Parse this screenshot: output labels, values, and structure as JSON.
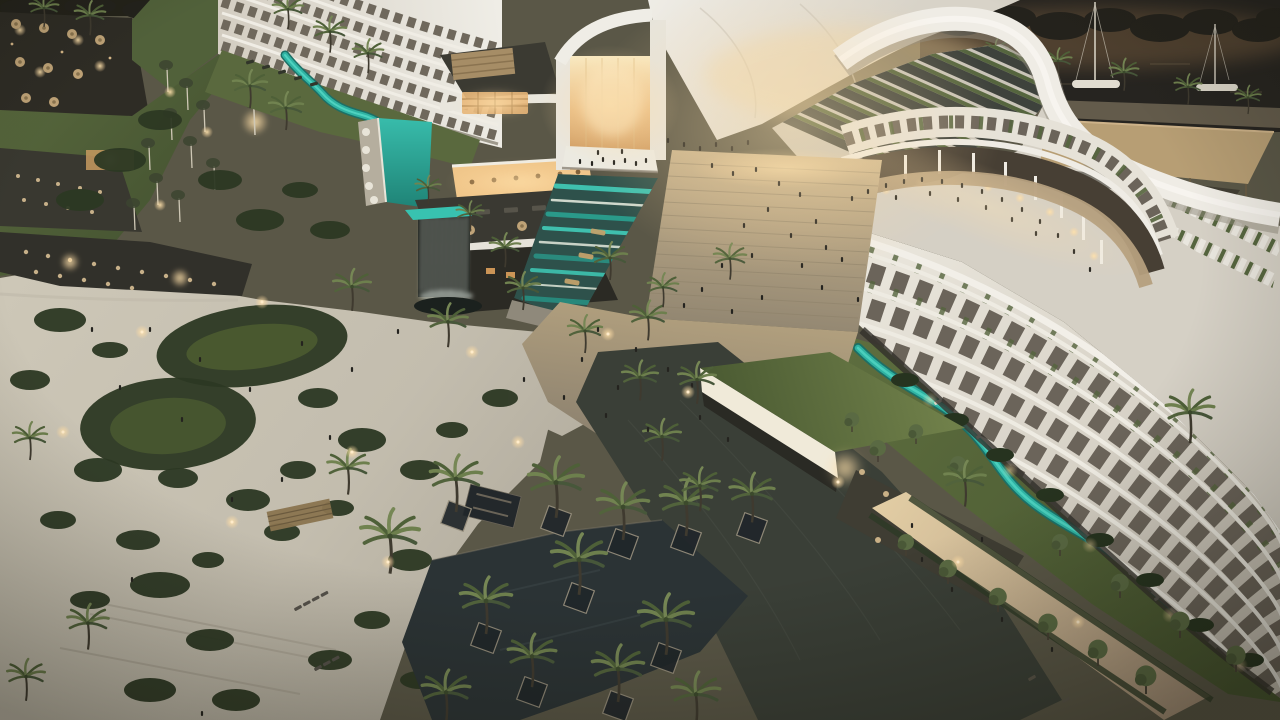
{
  "scene": {
    "title": "Aerial dusk rendering of a crescent-shaped luxury resort",
    "type": "architectural-visualization",
    "time_of_day": "dusk",
    "elements": [
      "curved white hotel wing with balcony grid",
      "glowing glass atrium under white canopy roof",
      "grand staircase with visitors",
      "curved retail colonnade promenade",
      "rooftop solar panels and green walls",
      "turquoise lazy river with sun loungers",
      "landscaped garden with looping paths",
      "palm groves",
      "dark reflecting pools with stone planters",
      "green-roof pavilion",
      "marina with sailboats",
      "beach club terraces with umbrellas",
      "waterfall and water cascade features"
    ]
  },
  "palette": {
    "base-ground": "#5a5747",
    "sand-path": "#cac4b4",
    "plaza-stone": "#998d76",
    "stair-stone": "#c3ad88",
    "paving-dark": "#3a3f37",
    "lawn": "#55663b",
    "lawn-dark": "#46552f",
    "shrub": "#2c3823",
    "river-teal": "#2fb3a3",
    "river-deep": "#1d6f66",
    "pool-dark": "#2b3335",
    "building-white": "#eceae2",
    "building-shade": "#d5d0c5",
    "window-dark": "#6b645a",
    "roof-panel": "#3e423c",
    "green-wall": "#55653e",
    "canopy-tan": "#b79e74",
    "warm-glow": "#ffdfa6",
    "marina-water": "#262420",
    "dusk-haze": "#b98a58",
    "figure-dark": "#24231f"
  }
}
